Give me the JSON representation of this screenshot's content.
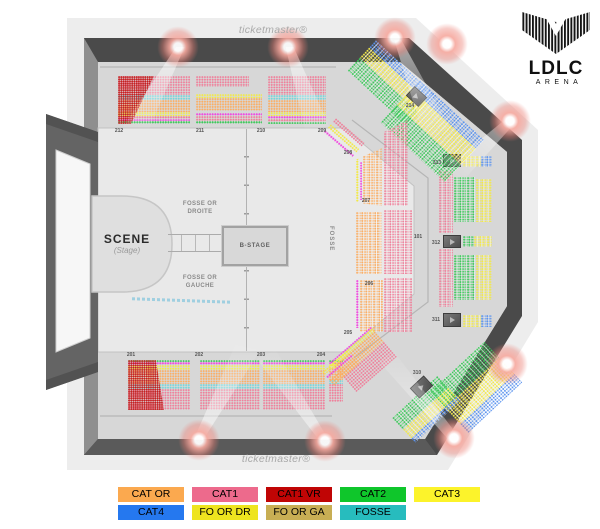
{
  "brand": {
    "watermark_top": "ticketmaster®",
    "watermark_bottom": "ticketmaster®"
  },
  "logo": {
    "name": "LDLC",
    "subtitle": "ARENA"
  },
  "map": {
    "stage_title": "SCENE",
    "stage_subtitle": "(Stage)",
    "b_stage_label": "B-STAGE",
    "fosse_right_line1": "FOSSE OR",
    "fosse_right_line2": "DROITE",
    "fosse_left_line1": "FOSSE OR",
    "fosse_left_line2": "GAUCHE",
    "fosse_pit_label": "FOSSE",
    "section_labels": [
      "212",
      "211",
      "210",
      "209",
      "208",
      "207",
      "206",
      "205",
      "204",
      "203",
      "202",
      "201",
      "214",
      "313",
      "312",
      "311",
      "310",
      "101"
    ]
  },
  "legend": {
    "items": [
      {
        "label": "CAT OR",
        "color": "#FBA94F"
      },
      {
        "label": "CAT1",
        "color": "#ED6A8C"
      },
      {
        "label": "CAT1 VR",
        "color": "#C00505"
      },
      {
        "label": "CAT2",
        "color": "#0FC62B"
      },
      {
        "label": "CAT3",
        "color": "#FCF32B"
      },
      {
        "label": "CAT4",
        "color": "#2578EF"
      },
      {
        "label": "FO OR DR",
        "color": "#EEE41F"
      },
      {
        "label": "FO OR GA",
        "color": "#C8AE54"
      },
      {
        "label": "FOSSE",
        "color": "#27BCBE"
      }
    ]
  }
}
